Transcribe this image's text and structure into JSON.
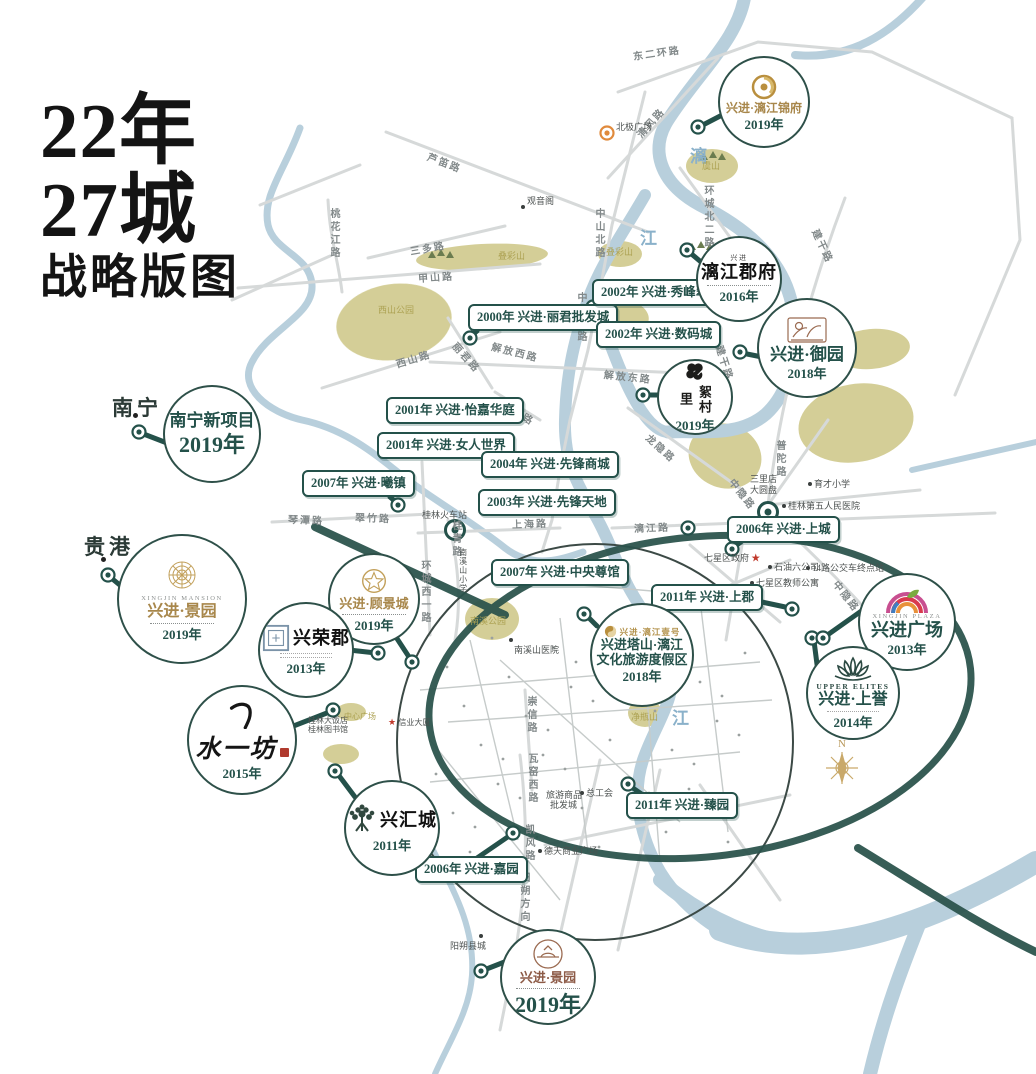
{
  "title": {
    "line1": "22年",
    "line2": "27城",
    "line3": "战略版图"
  },
  "compass": {
    "label": "N"
  },
  "colors": {
    "accent": "#24514a",
    "gold": "#b3924c",
    "river": "#b8cfdc",
    "park": "#cdc685",
    "road": "#d6d9d9",
    "ring": "#2b534c",
    "sepia": "#9a6a50"
  },
  "cities": [
    {
      "name": "南宁",
      "x": 112,
      "y": 392,
      "dot_x": 133,
      "dot_y": 413
    },
    {
      "name": "贵港",
      "x": 84,
      "y": 531,
      "dot_x": 101,
      "dot_y": 557
    }
  ],
  "river_labels": [
    {
      "text": "漓",
      "x": 690,
      "y": 142
    },
    {
      "text": "江",
      "x": 640,
      "y": 224
    },
    {
      "text": "江",
      "x": 672,
      "y": 704
    }
  ],
  "event_labels": [
    {
      "year": "2000年",
      "name": "兴进·丽君批发城",
      "x": 468,
      "y": 304
    },
    {
      "year": "2002年",
      "name": "兴进·秀峰翠苑",
      "x": 592,
      "y": 279
    },
    {
      "year": "2002年",
      "name": "兴进·数码城",
      "x": 596,
      "y": 321
    },
    {
      "year": "2001年",
      "name": "兴进·怡嘉华庭",
      "x": 386,
      "y": 397
    },
    {
      "year": "2001年",
      "name": "兴进·女人世界",
      "x": 377,
      "y": 432
    },
    {
      "year": "2004年",
      "name": "兴进·先锋商城",
      "x": 481,
      "y": 451
    },
    {
      "year": "2003年",
      "name": "兴进·先锋天地",
      "x": 478,
      "y": 489
    },
    {
      "year": "2007年",
      "name": "兴进·曦镇",
      "x": 302,
      "y": 470
    },
    {
      "year": "2006年",
      "name": "兴进·上城",
      "x": 727,
      "y": 516
    },
    {
      "year": "2007年",
      "name": "兴进·中央尊馆",
      "x": 491,
      "y": 559
    },
    {
      "year": "2011年",
      "name": "兴进·上郡",
      "x": 651,
      "y": 584
    },
    {
      "year": "2011年",
      "name": "兴进·臻园",
      "x": 626,
      "y": 792
    },
    {
      "year": "2006年",
      "name": "兴进·嘉园",
      "x": 415,
      "y": 856
    }
  ],
  "projects": [
    {
      "id": "lijiang-jinfu",
      "cx": 762,
      "cy": 100,
      "r": 44,
      "logo": "gold-swirl",
      "name": "兴进·漓江锦府",
      "name_style": "gold",
      "name_size": 12,
      "sub": "LI RIVER LUXURY",
      "year": "2019年"
    },
    {
      "id": "lijiang-junfu",
      "cx": 737,
      "cy": 277,
      "r": 41,
      "logo": "dotted",
      "seal": "兴进",
      "name": "漓江郡府",
      "name_style": "blackbig",
      "year": "2016年"
    },
    {
      "id": "yuyuan",
      "cx": 805,
      "cy": 346,
      "r": 48,
      "logo": "sepia-etch",
      "name": "兴进·御园",
      "name_style": "teal",
      "name_size": 17,
      "year": "2018年"
    },
    {
      "id": "xucunli",
      "cx": 693,
      "cy": 395,
      "r": 36,
      "logo": "clover",
      "name": "絮村里",
      "vertical_name": true,
      "year": "2019年"
    },
    {
      "id": "nanning-new",
      "cx": 210,
      "cy": 432,
      "r": 47,
      "logo": "none",
      "name": "南宁新项目",
      "name_style": "teal",
      "name_size": 17,
      "year": "2019年",
      "big_year": true
    },
    {
      "id": "jingyuan-west",
      "cx": 180,
      "cy": 597,
      "r": 63,
      "logo": "gold-mandala",
      "en": "XINGJIN MANSION",
      "name": "兴进·景园",
      "name_style": "gold",
      "name_size": 16,
      "dots": true,
      "year": "2019年"
    },
    {
      "id": "gujingcheng",
      "cx": 372,
      "cy": 597,
      "r": 44,
      "logo": "gold-star",
      "name": "兴进·顾景城",
      "name_style": "gold",
      "name_size": 13,
      "dots": true,
      "year": "2019年"
    },
    {
      "id": "xingrongjun",
      "cx": 304,
      "cy": 648,
      "r": 46,
      "logo": "blue-seal",
      "name": "兴荣郡",
      "name_style": "blackbig",
      "side_logo": true,
      "micro": 2,
      "year": "2013年"
    },
    {
      "id": "shuiyifang",
      "cx": 240,
      "cy": 738,
      "r": 53,
      "logo": "brush",
      "name": "水一坊",
      "year": "2015年"
    },
    {
      "id": "xinghuicheng",
      "cx": 390,
      "cy": 826,
      "r": 46,
      "logo": "tree",
      "name": "兴汇城",
      "name_style": "blackbig",
      "side_logo": true,
      "year": "2011年"
    },
    {
      "id": "tashan-resort",
      "cx": 640,
      "cy": 653,
      "r": 50,
      "logo": "gold-yinyang",
      "brand": "兴进·漓江壹号",
      "name": "兴进塔山·漓江",
      "name2": "文化旅游度假区",
      "name_style": "teal",
      "name_size": 13,
      "year": "2018年"
    },
    {
      "id": "xingjin-plaza",
      "cx": 905,
      "cy": 620,
      "r": 47,
      "logo": "rainbow",
      "name": "兴进广场",
      "name_style": "teal",
      "name_size": 18,
      "en": "XINGJIN PLAZA",
      "year": "2013年"
    },
    {
      "id": "shangyu",
      "cx": 851,
      "cy": 691,
      "r": 45,
      "logo": "lotus",
      "name": "兴进·上誉",
      "name_style": "teal",
      "name_size": 16,
      "en": "UPPER ELITES",
      "en_style": "teal",
      "micro": 1,
      "year": "2014年"
    },
    {
      "id": "jingyuan-south",
      "cx": 546,
      "cy": 975,
      "r": 46,
      "logo": "sepia-seal",
      "name": "兴进·景园",
      "name_style": "sepia",
      "name_size": 13,
      "dots": true,
      "year": "2019年",
      "big_year": true
    }
  ],
  "road_labels": [
    {
      "t": "东二环路",
      "x": 633,
      "y": 48,
      "rot": -8
    },
    {
      "t": "清风路",
      "x": 638,
      "y": 128,
      "rot": -48
    },
    {
      "t": "芦笛路",
      "x": 428,
      "y": 148,
      "rot": 21
    },
    {
      "t": "环城北二路",
      "x": 700,
      "y": 185,
      "vert": true
    },
    {
      "t": "三多路",
      "x": 410,
      "y": 243,
      "rot": -10
    },
    {
      "t": "甲山路",
      "x": 418,
      "y": 270,
      "rot": -4
    },
    {
      "t": "桃花江路",
      "x": 326,
      "y": 208,
      "vert": true
    },
    {
      "t": "西山路",
      "x": 396,
      "y": 356,
      "rot": -17
    },
    {
      "t": "丽君路",
      "x": 455,
      "y": 336,
      "rot": 48
    },
    {
      "t": "中山北路",
      "x": 591,
      "y": 208,
      "vert": true
    },
    {
      "t": "中山中路",
      "x": 573,
      "y": 292,
      "vert": true
    },
    {
      "t": "解放西路",
      "x": 492,
      "y": 338,
      "rot": 14
    },
    {
      "t": "解放东路",
      "x": 604,
      "y": 366,
      "rot": 6
    },
    {
      "t": "五美路",
      "x": 503,
      "y": 396,
      "rot": 30
    },
    {
      "t": "琴潭路",
      "x": 288,
      "y": 511,
      "rot": 2
    },
    {
      "t": "翠竹路",
      "x": 355,
      "y": 509,
      "rot": 2
    },
    {
      "t": "环城西一路",
      "x": 417,
      "y": 560,
      "vert": true
    },
    {
      "t": "桂青路",
      "x": 448,
      "y": 520,
      "vert": true
    },
    {
      "t": "龙隐路",
      "x": 648,
      "y": 428,
      "rot": 42
    },
    {
      "t": "普陀路",
      "x": 772,
      "y": 440,
      "vert": true
    },
    {
      "t": "建干路",
      "x": 816,
      "y": 222,
      "rot": 65
    },
    {
      "t": "建干路",
      "x": 720,
      "y": 338,
      "rot": 72
    },
    {
      "t": "上海路",
      "x": 512,
      "y": 516,
      "rot": -2
    },
    {
      "t": "漓江路",
      "x": 634,
      "y": 520,
      "rot": -2
    },
    {
      "t": "中隐路",
      "x": 732,
      "y": 472,
      "rot": 52
    },
    {
      "t": "中隐路",
      "x": 836,
      "y": 574,
      "rot": 52
    },
    {
      "t": "崇信路",
      "x": 523,
      "y": 696,
      "vert": true
    },
    {
      "t": "瓦窑西路",
      "x": 524,
      "y": 753,
      "vert": true
    },
    {
      "t": "凯风路",
      "x": 521,
      "y": 824,
      "vert": true
    },
    {
      "t": "阳朔方向",
      "x": 516,
      "y": 872,
      "vert": true
    }
  ],
  "pois": [
    {
      "t": "北极广场",
      "x": 616,
      "y": 122
    },
    {
      "t": "观音阁",
      "x": 527,
      "y": 196,
      "dot": true,
      "dx": 521,
      "dy": 205
    },
    {
      "t": "虞山",
      "x": 702,
      "y": 161,
      "cls": "gold"
    },
    {
      "t": "叠彩山",
      "x": 498,
      "y": 251,
      "cls": "gold"
    },
    {
      "t": "叠彩山",
      "x": 606,
      "y": 247,
      "cls": "gold"
    },
    {
      "t": "西山公园",
      "x": 378,
      "y": 305,
      "cls": "gold"
    },
    {
      "t": "桂林火车站",
      "x": 422,
      "y": 510
    },
    {
      "t": "南溪山小学",
      "x": 458,
      "y": 548,
      "vert": true,
      "tiny": true
    },
    {
      "t": "南溪公园",
      "x": 470,
      "y": 616,
      "cls": "gold"
    },
    {
      "t": "南溪山医院",
      "x": 514,
      "y": 645,
      "dot": true,
      "dx": 509,
      "dy": 638
    },
    {
      "t": "净瓶山",
      "x": 631,
      "y": 712,
      "cls": "gold"
    },
    {
      "t": "七星区政府",
      "x": 704,
      "y": 553,
      "star_after": true
    },
    {
      "t": "石油六公司",
      "x": 774,
      "y": 562,
      "dot": true,
      "dx": 768,
      "dy": 565
    },
    {
      "t": "七星区教师公寓",
      "x": 756,
      "y": 578,
      "dot": true,
      "dx": 750,
      "dy": 581
    },
    {
      "t": "14路公交车终点站",
      "x": 812,
      "y": 563,
      "dot": true,
      "dx": 806,
      "dy": 566
    },
    {
      "t": "三里店",
      "x": 750,
      "y": 474
    },
    {
      "t": "大圆盘",
      "x": 750,
      "y": 485
    },
    {
      "t": "育才小学",
      "x": 814,
      "y": 479,
      "dot": true,
      "dx": 808,
      "dy": 482
    },
    {
      "t": "桂林第五人民医院",
      "x": 788,
      "y": 501,
      "dot": true,
      "dx": 782,
      "dy": 504
    },
    {
      "t": "德天商业广场",
      "x": 544,
      "y": 846,
      "dot": true,
      "dx": 538,
      "dy": 849
    },
    {
      "t": "总工会",
      "x": 586,
      "y": 788,
      "dot": true,
      "dx": 580,
      "dy": 791
    },
    {
      "t": "旅游商品",
      "x": 546,
      "y": 790
    },
    {
      "t": "批发城",
      "x": 550,
      "y": 800
    },
    {
      "t": "阳朔县城",
      "x": 450,
      "y": 941,
      "dot": true,
      "dx": 479,
      "dy": 934
    },
    {
      "t": "信业大厦",
      "x": 388,
      "y": 717,
      "star_before": true,
      "tiny": true
    },
    {
      "t": "桂林大饭店",
      "x": 308,
      "y": 716,
      "tiny": true
    },
    {
      "t": "桂林图书馆",
      "x": 308,
      "y": 725,
      "tiny": true
    },
    {
      "t": "中心广场",
      "x": 344,
      "y": 712,
      "cls": "gold",
      "tiny": true
    }
  ],
  "markers": [
    {
      "x": 698,
      "y": 127
    },
    {
      "x": 687,
      "y": 250
    },
    {
      "x": 740,
      "y": 352
    },
    {
      "x": 643,
      "y": 395
    },
    {
      "x": 139,
      "y": 432
    },
    {
      "x": 108,
      "y": 575
    },
    {
      "x": 412,
      "y": 662
    },
    {
      "x": 378,
      "y": 653
    },
    {
      "x": 333,
      "y": 710
    },
    {
      "x": 335,
      "y": 771
    },
    {
      "x": 584,
      "y": 614
    },
    {
      "x": 792,
      "y": 609
    },
    {
      "x": 812,
      "y": 638
    },
    {
      "x": 823,
      "y": 638
    },
    {
      "x": 688,
      "y": 528
    },
    {
      "x": 732,
      "y": 549
    },
    {
      "x": 768,
      "y": 512,
      "big": true
    },
    {
      "x": 455,
      "y": 530,
      "big": true
    },
    {
      "x": 628,
      "y": 784
    },
    {
      "x": 513,
      "y": 833
    },
    {
      "x": 481,
      "y": 971
    },
    {
      "x": 398,
      "y": 505
    },
    {
      "x": 470,
      "y": 338
    },
    {
      "x": 593,
      "y": 307
    },
    {
      "x": 607,
      "y": 133,
      "orange": true
    }
  ]
}
